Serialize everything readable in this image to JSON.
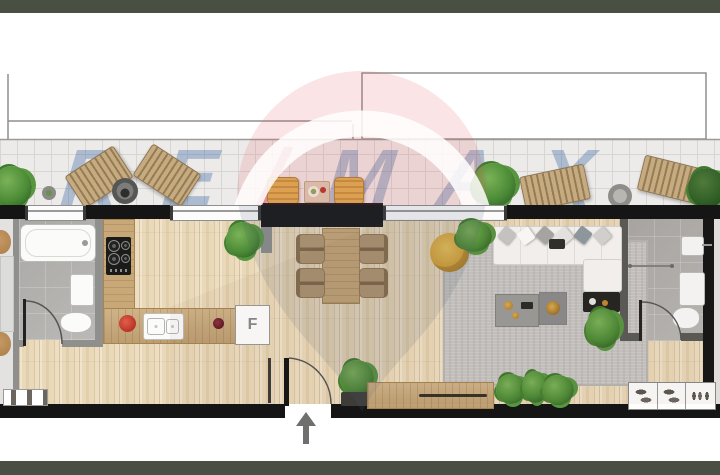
{
  "watermark": {
    "brand": "RE/MAX",
    "re": "RE",
    "slash": "/",
    "max": "MAX"
  },
  "labels": {
    "fridge": "F"
  },
  "palette": {
    "frame_bar": "#4a4f44",
    "exterior_wall": "#151515",
    "partition_wall": "#8f8f8d",
    "terrace_tile": "#ecebe9",
    "parquet_floor": "#ead9b9",
    "bathroom_tile": "#b5b3b0",
    "wood_furniture": "#c9a878",
    "rug_gray": "#c6c5c3",
    "sofa_white": "#f8f7f5",
    "accent_yellow": "#dfa93b",
    "plant_green": "#4c8c36",
    "watermark_blue": "#1a50a0",
    "watermark_red": "#d02330"
  }
}
